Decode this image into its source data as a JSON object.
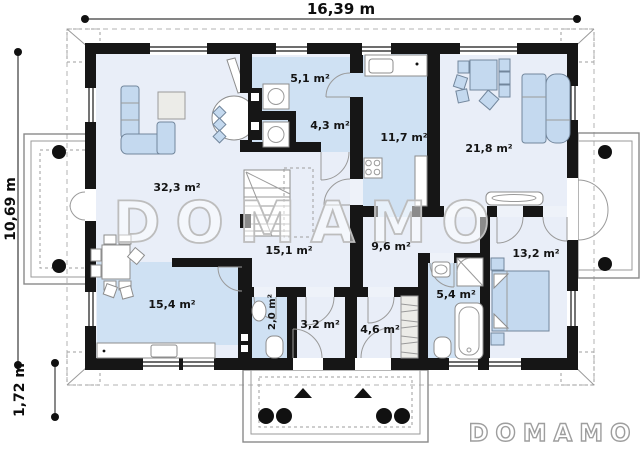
{
  "plan": {
    "title": "single-storey house floor plan",
    "dimensions": {
      "width": "16,39 m",
      "height": "10,69 m",
      "porch_depth": "1,72 m"
    },
    "rooms": [
      {
        "name": "living-room",
        "area": "32,3 m²"
      },
      {
        "name": "utility-room",
        "area": "5,1 m²"
      },
      {
        "name": "boiler-room",
        "area": "4,3 m²"
      },
      {
        "name": "kitchen",
        "area": "11,7 m²"
      },
      {
        "name": "lounge",
        "area": "21,8 m²"
      },
      {
        "name": "hall",
        "area": "15,1 m²"
      },
      {
        "name": "corridor",
        "area": "9,6 m²"
      },
      {
        "name": "bedroom",
        "area": "13,2 m²"
      },
      {
        "name": "dining-room",
        "area": "15,4 m²"
      },
      {
        "name": "wc",
        "area": "2,0 m²"
      },
      {
        "name": "vestibule",
        "area": "3,2 m²"
      },
      {
        "name": "wardrobe",
        "area": "4,6 m²"
      },
      {
        "name": "bathroom",
        "area": "5,4 m²"
      }
    ],
    "watermark": {
      "center": "DOMAMO",
      "logo": "DOMAMO"
    },
    "colors": {
      "wall": "#161616",
      "floor": "#e9eef8",
      "floor_accent": "#cfe1f3",
      "furniture": "#c4d9ef",
      "watermark": "#bdbdbd"
    }
  }
}
